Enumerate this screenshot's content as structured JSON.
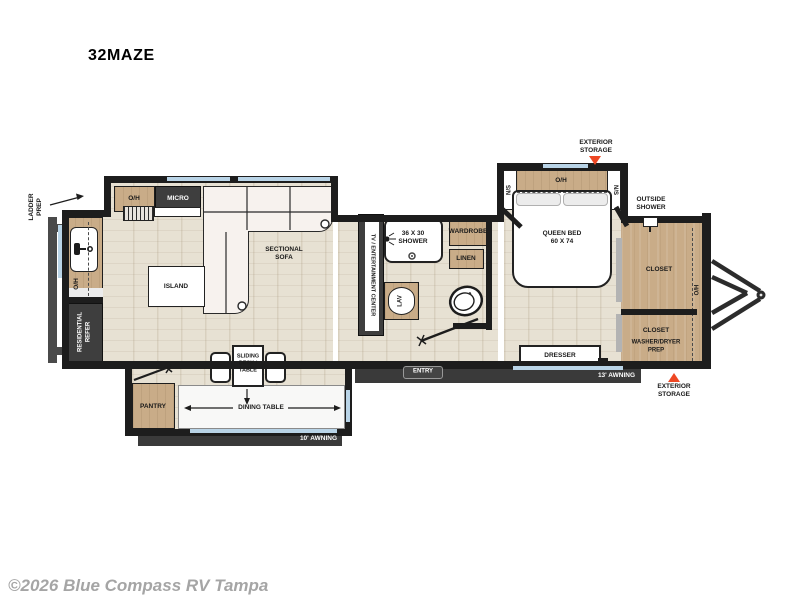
{
  "title": "32MAZE",
  "watermark": "©2026 Blue Compass RV Tampa",
  "colors": {
    "accent": "#ee4723",
    "window": "#b9d4e7",
    "wood": "#c9ac88",
    "wall": "#1d1d1d"
  },
  "exterior": {
    "ladder_prep": "LADDER\nPREP",
    "storage_top": "EXTERIOR\nSTORAGE",
    "storage_front": "EXTERIOR\nSTORAGE",
    "outside_shower": "OUTSIDE\nSHOWER",
    "awning_main": "13' AWNING",
    "awning_rear": "10' AWNING",
    "entry": "ENTRY"
  },
  "kitchen": {
    "overhead": "O/H",
    "micro": "MICRO",
    "counter_overhead": "O/H",
    "refer": "RESIDENTIAL\nREFER",
    "island": "ISLAND",
    "pantry": "PANTRY"
  },
  "living": {
    "sofa": "SECTIONAL\nSOFA",
    "tv": "TV / ENTERTAINMENT CENTER",
    "sliding_desk": "SLIDING\nDESK /\nTABLE",
    "dining": "DINING TABLE"
  },
  "bath": {
    "shower": "36 X 30\nSHOWER",
    "wardrobe": "WARDROBE",
    "linen": "LINEN",
    "lav": "LAV"
  },
  "bedroom": {
    "bed": "QUEEN BED\n60 X 74",
    "overhead": "O/H",
    "ns_left": "N/S",
    "ns_right": "N/S",
    "dresser": "DRESSER"
  },
  "front": {
    "closet_top": "CLOSET",
    "closet_bottom": "CLOSET",
    "washer_dryer": "WASHER/DRYER\nPREP",
    "overhead": "O/H"
  }
}
